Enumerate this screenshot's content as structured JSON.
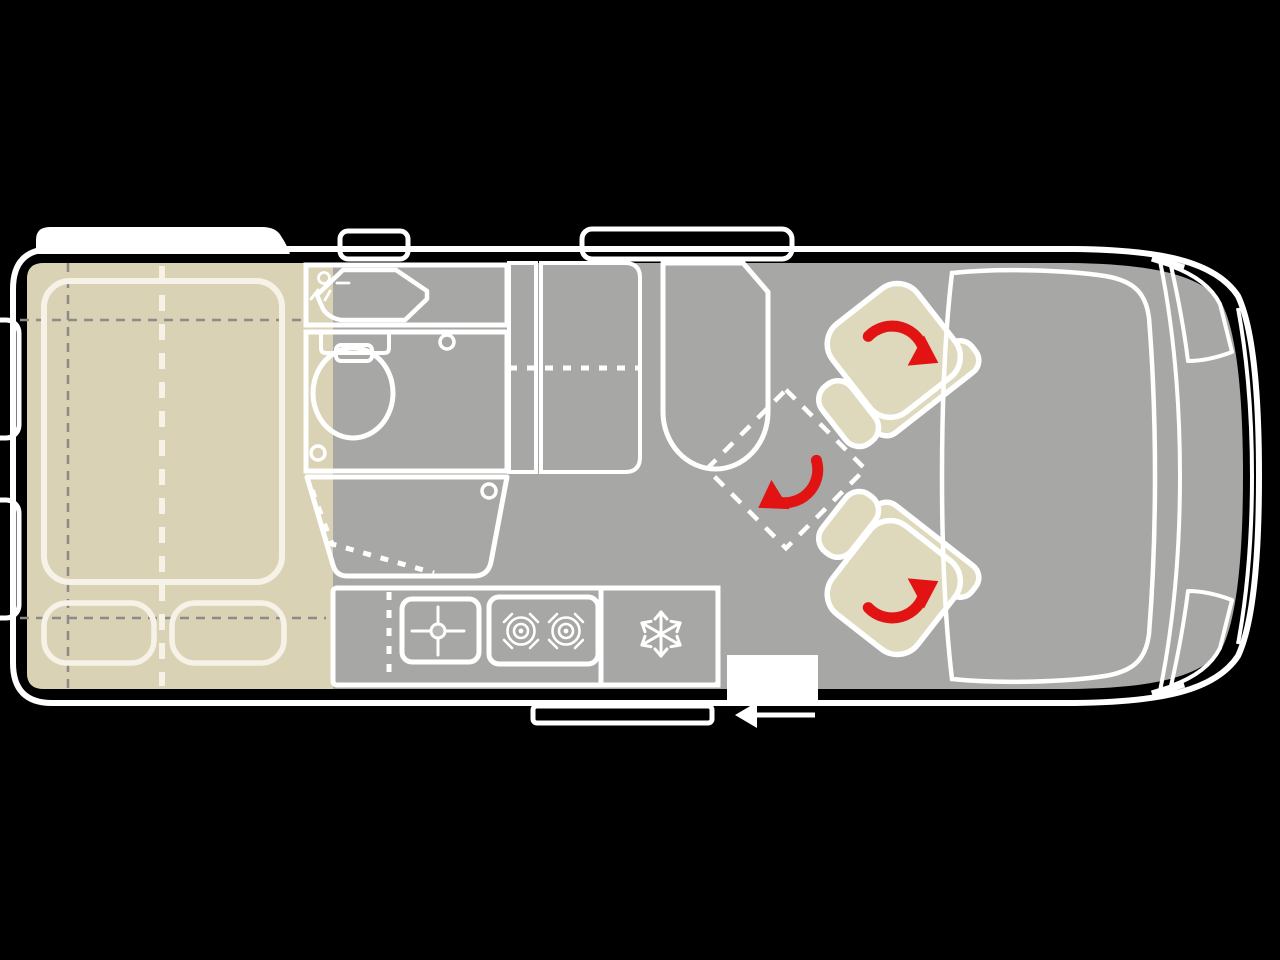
{
  "diagram": {
    "type": "campervan-floorplan-top-view",
    "orientation": "vehicle-front-right-rear-left"
  },
  "colors": {
    "background": "#000000",
    "body_shell": "#9b9b99",
    "floor": "#a7a7a5",
    "outline_white": "#ffffff",
    "bed_wood": "#dad2b4",
    "bathroom": "#ccd8e1",
    "bathroom_fixture": "#b5c8d6",
    "wardrobe": "#d6d3b3",
    "kitchen_counter": "#d4ddd4",
    "kitchen_module": "#b6b6b4",
    "fridge_green": "#abc5ae",
    "bench_pink": "#e0bbaf",
    "table_pink": "#d9b3a8",
    "seat_beige": "#ded9bc",
    "cab_dashboard": "#dcdcdc",
    "headlight": "#e3e3e3",
    "accent_red": "#e21313",
    "step_white": "#ffffff",
    "window_black": "#000000"
  },
  "regions": {
    "rear_bed": "transverse double bed with two pillows",
    "bathroom": "washroom with sink, toilet and fold-away shower",
    "wardrobe": "tall cabinet with dotted shelf line",
    "kitchen": "kitchenette with sink, two-burner hob and fridge",
    "dinette": "pink bench with swivel table",
    "cab": "driver cab with two rotating seats"
  },
  "icons": {
    "faucet": "faucet-spray-icon",
    "sink_cross": "sink-faucet-cross-icon",
    "burners": "twin-burner-hob-icon",
    "snowflake": "fridge-snowflake-icon",
    "rotation_arrows": "red-rotation-arrow",
    "door_arrow": "sliding-door-direction-arrow"
  }
}
